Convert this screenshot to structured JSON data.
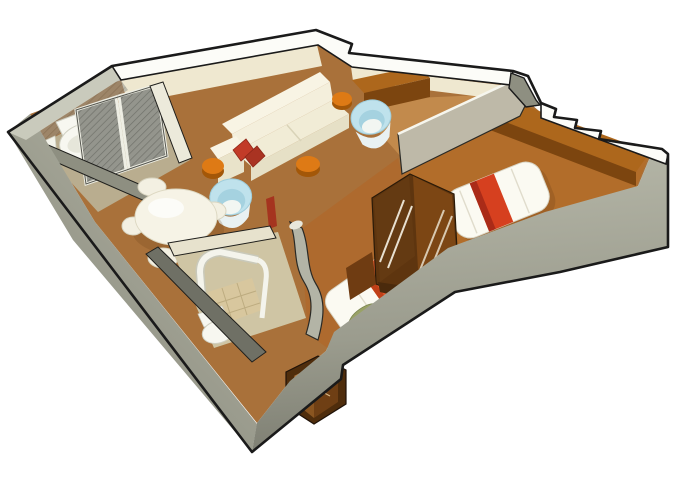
{
  "scene": {
    "title": "isometric-3d-floor-plan-cutaway",
    "subject": "stateroom / suite floor plan with living room, two bedrooms and two bathrooms",
    "background": "#ffffff"
  },
  "palette": {
    "outline": "#1a1a1a",
    "wall_light": "#b6b7a8",
    "wall_mid": "#8e8f81",
    "wall_dark": "#6f7065",
    "wall_white": "#fcfcf8",
    "wall_beige": "#efe8d0",
    "wall_inner_gray": "#c9cabc",
    "floor": "#a9713a",
    "floor_bedroom": "#b26d2a",
    "floor_light": "#c28a4c",
    "floor_bath": "#b9ad8f",
    "tile": "#d8c79e",
    "wood": "#ad671c",
    "wood_dark": "#7c450f",
    "wood_deep": "#5e350f",
    "sofa_cream": "#f4efdc",
    "sofa_shade": "#e6e0c6",
    "white_furniture": "#f6f3e6",
    "pillow_red": "#c23b28",
    "bed_white": "#fbfaf2",
    "bed_red": "#d6401f",
    "bed_orange": "#e2582a",
    "pillow_green": "#99a266",
    "stool_orange": "#de7a15",
    "stool_side": "#a35708",
    "chair_blue": "#bfe2ec",
    "chair_blue_shade": "#a5d2e0",
    "mesh": "#94958d"
  },
  "objects": [
    {
      "name": "bathroom-1",
      "items": [
        "toilet",
        "mesh-sliding-doors"
      ]
    },
    {
      "name": "living-dining-area",
      "items": [
        "sofa",
        "red-throw-pillows",
        "console-desk",
        "blue-tub-chair",
        "orange-stools",
        "round-dining-table",
        "dining-chairs"
      ]
    },
    {
      "name": "bedroom-1",
      "items": [
        "double-bed-red-runner",
        "long-desk",
        "open-wardrobe"
      ]
    },
    {
      "name": "bedroom-2",
      "items": [
        "bed-orange-runner",
        "green-pillow"
      ]
    },
    {
      "name": "bathroom-2",
      "items": [
        "curved-shower",
        "toilet",
        "tiled-floor"
      ]
    },
    {
      "name": "hall",
      "items": [
        "storage-box"
      ]
    }
  ]
}
